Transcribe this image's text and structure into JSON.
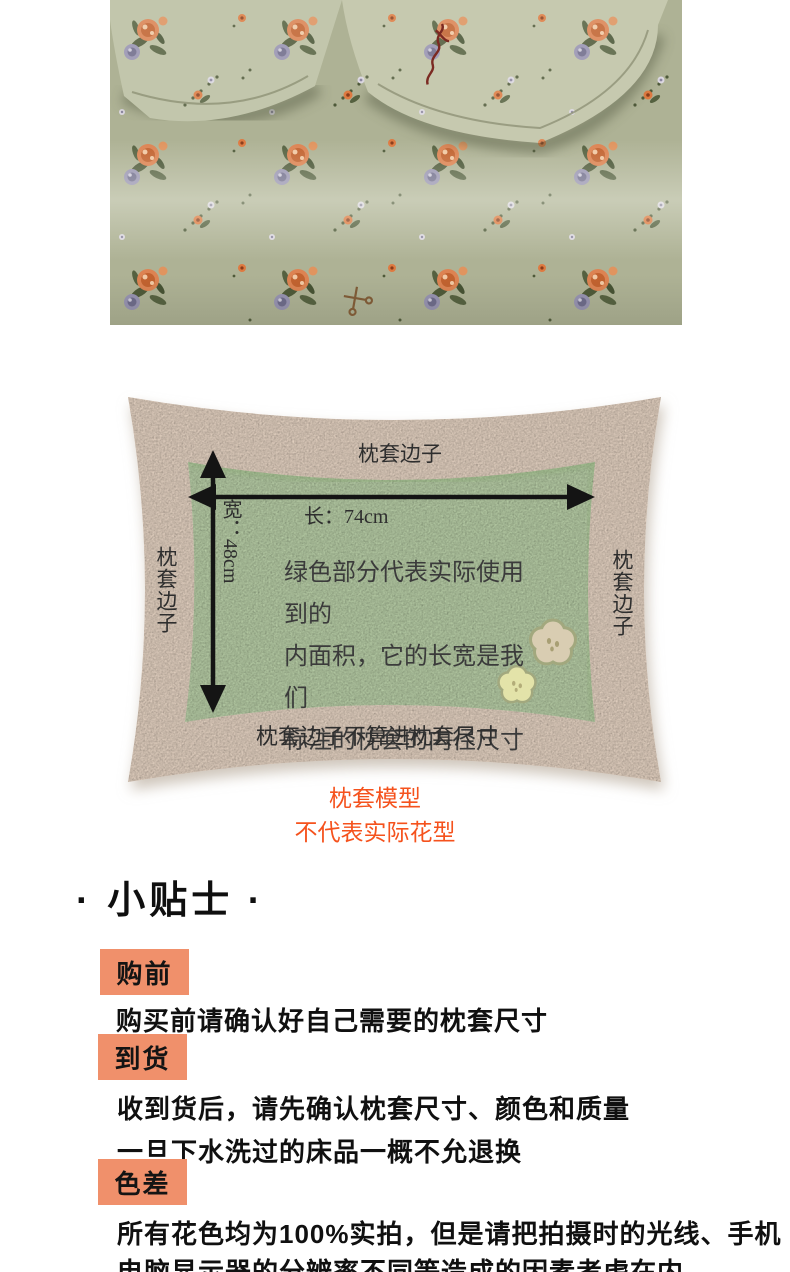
{
  "photo": {
    "description": "floral bedding photo: two pillows on sheet, sage green fabric with orange and purple roses",
    "palette": {
      "sheet": "#aeb295",
      "pillow": "#bdc0a3",
      "rose_orange": "#dd8352",
      "rose_purple": "#9793b2",
      "leaf": "#4e5939",
      "signature": "#7b2a22"
    }
  },
  "diagram": {
    "top_edge_label": "枕套边子",
    "left_edge_label": "枕套边子",
    "right_edge_label": "枕套边子",
    "length_label": "长：74cm",
    "width_label": "宽：48cm",
    "inner_note_lines": {
      "0": "绿色部分代表实际使用到的",
      "1": "内面积，它的长宽是我们",
      "2": "标注的枕套的内径尺寸"
    },
    "bottom_note": "枕套边子不算进枕套尺寸",
    "caption_line1": "枕套模型",
    "caption_line2": "不代表实际花型",
    "colors": {
      "pillow_cream": "#fce8d6",
      "inner_green": "#cbe3b8",
      "caption_orange": "#f5521d",
      "arrow_black": "#141414"
    }
  },
  "tips": {
    "title": "· 小贴士 ·",
    "badge_color": "#f0906b",
    "items": {
      "0": {
        "badge": "购前",
        "lines": {
          "0": "购买前请确认好自己需要的枕套尺寸"
        }
      },
      "1": {
        "badge": "到货",
        "lines": {
          "0": "收到货后，请先确认枕套尺寸、颜色和质量",
          "1": "一旦下水洗过的床品一概不允退换"
        }
      },
      "2": {
        "badge": "色差",
        "lines": {
          "0": "所有花色均为100%实拍，但是请把拍摄时的光线、手机",
          "1": "电脑显示器的分辨率不同等造成的因素考虑在内"
        }
      }
    }
  }
}
